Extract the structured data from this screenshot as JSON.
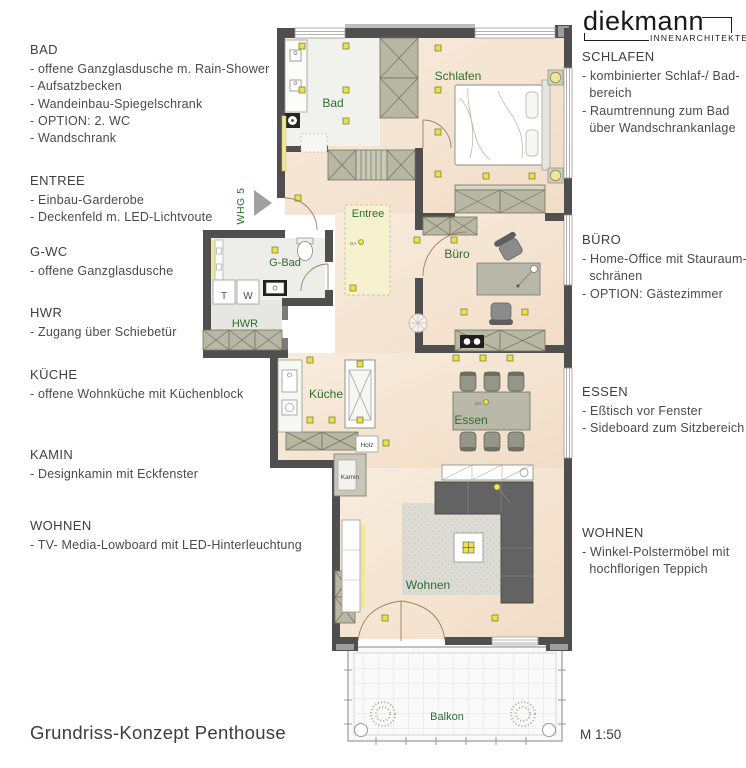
{
  "header": {
    "logo_name": "diekmann",
    "logo_subtitle": "INNENARCHITEKTEN"
  },
  "left_annotations": [
    {
      "title": "BAD",
      "items": [
        "- offene Ganzglasdusche m. Rain-Shower",
        "- Aufsatzbecken",
        "- Wandeinbau-Spiegelschrank",
        "- OPTION: 2. WC",
        "- Wandschrank"
      ]
    },
    {
      "title": "ENTREE",
      "items": [
        "- Einbau-Garderobe",
        "- Deckenfeld m. LED-Lichtvoute"
      ]
    },
    {
      "title": "G-WC",
      "items": [
        "- offene Ganzglasdusche"
      ]
    },
    {
      "title": "HWR",
      "items": [
        "- Zugang über Schiebetür"
      ]
    },
    {
      "title": "KÜCHE",
      "items": [
        "- offene Wohnküche mit Küchenblock"
      ]
    },
    {
      "title": "KAMIN",
      "items": [
        "- Designkamin mit Eckfenster"
      ]
    },
    {
      "title": "WOHNEN",
      "items": [
        "- TV- Media-Lowboard mit LED-Hinterleuchtung"
      ]
    }
  ],
  "right_annotations": [
    {
      "title": "SCHLAFEN",
      "items": [
        "- kombinierter Schlaf-/ Bad-",
        "  bereich",
        "- Raumtrennung zum Bad",
        "  über Wandschrankanlage"
      ]
    },
    {
      "title": "BÜRO",
      "items": [
        "- Home-Office mit Stauraum-",
        "  schränen",
        "- OPTION: Gästezimmer"
      ]
    },
    {
      "title": "ESSEN",
      "items": [
        "- Eßtisch vor Fenster",
        "- Sideboard zum Sitzbereich"
      ]
    },
    {
      "title": "WOHNEN",
      "items": [
        "- Winkel-Polstermöbel mit",
        "  hochflorigen Teppich"
      ]
    }
  ],
  "plan": {
    "unit_label": "WHG 5",
    "labels": {
      "bad": "Bad",
      "schlafen": "Schlafen",
      "entree": "Entree",
      "gbad": "G-Bad",
      "hwr": "HWR",
      "buero": "Büro",
      "kueche": "Küche",
      "essen": "Essen",
      "wohnen": "Wohnen",
      "balkon": "Balkon",
      "t": "T",
      "w": "W",
      "holz": "Holz",
      "kamin": "Kamin",
      "da": "DA"
    }
  },
  "footer": {
    "title": "Grundriss-Konzept Penthouse",
    "scale": "M 1:50"
  },
  "colors": {
    "wall": "#4f4f4f",
    "wood": "#f5e6d4",
    "tile": "#efefec",
    "wardrobe": "#b7b7a3",
    "led": "#efe79b",
    "light": "#e9e24b",
    "label_green": "#2f6d2f"
  }
}
